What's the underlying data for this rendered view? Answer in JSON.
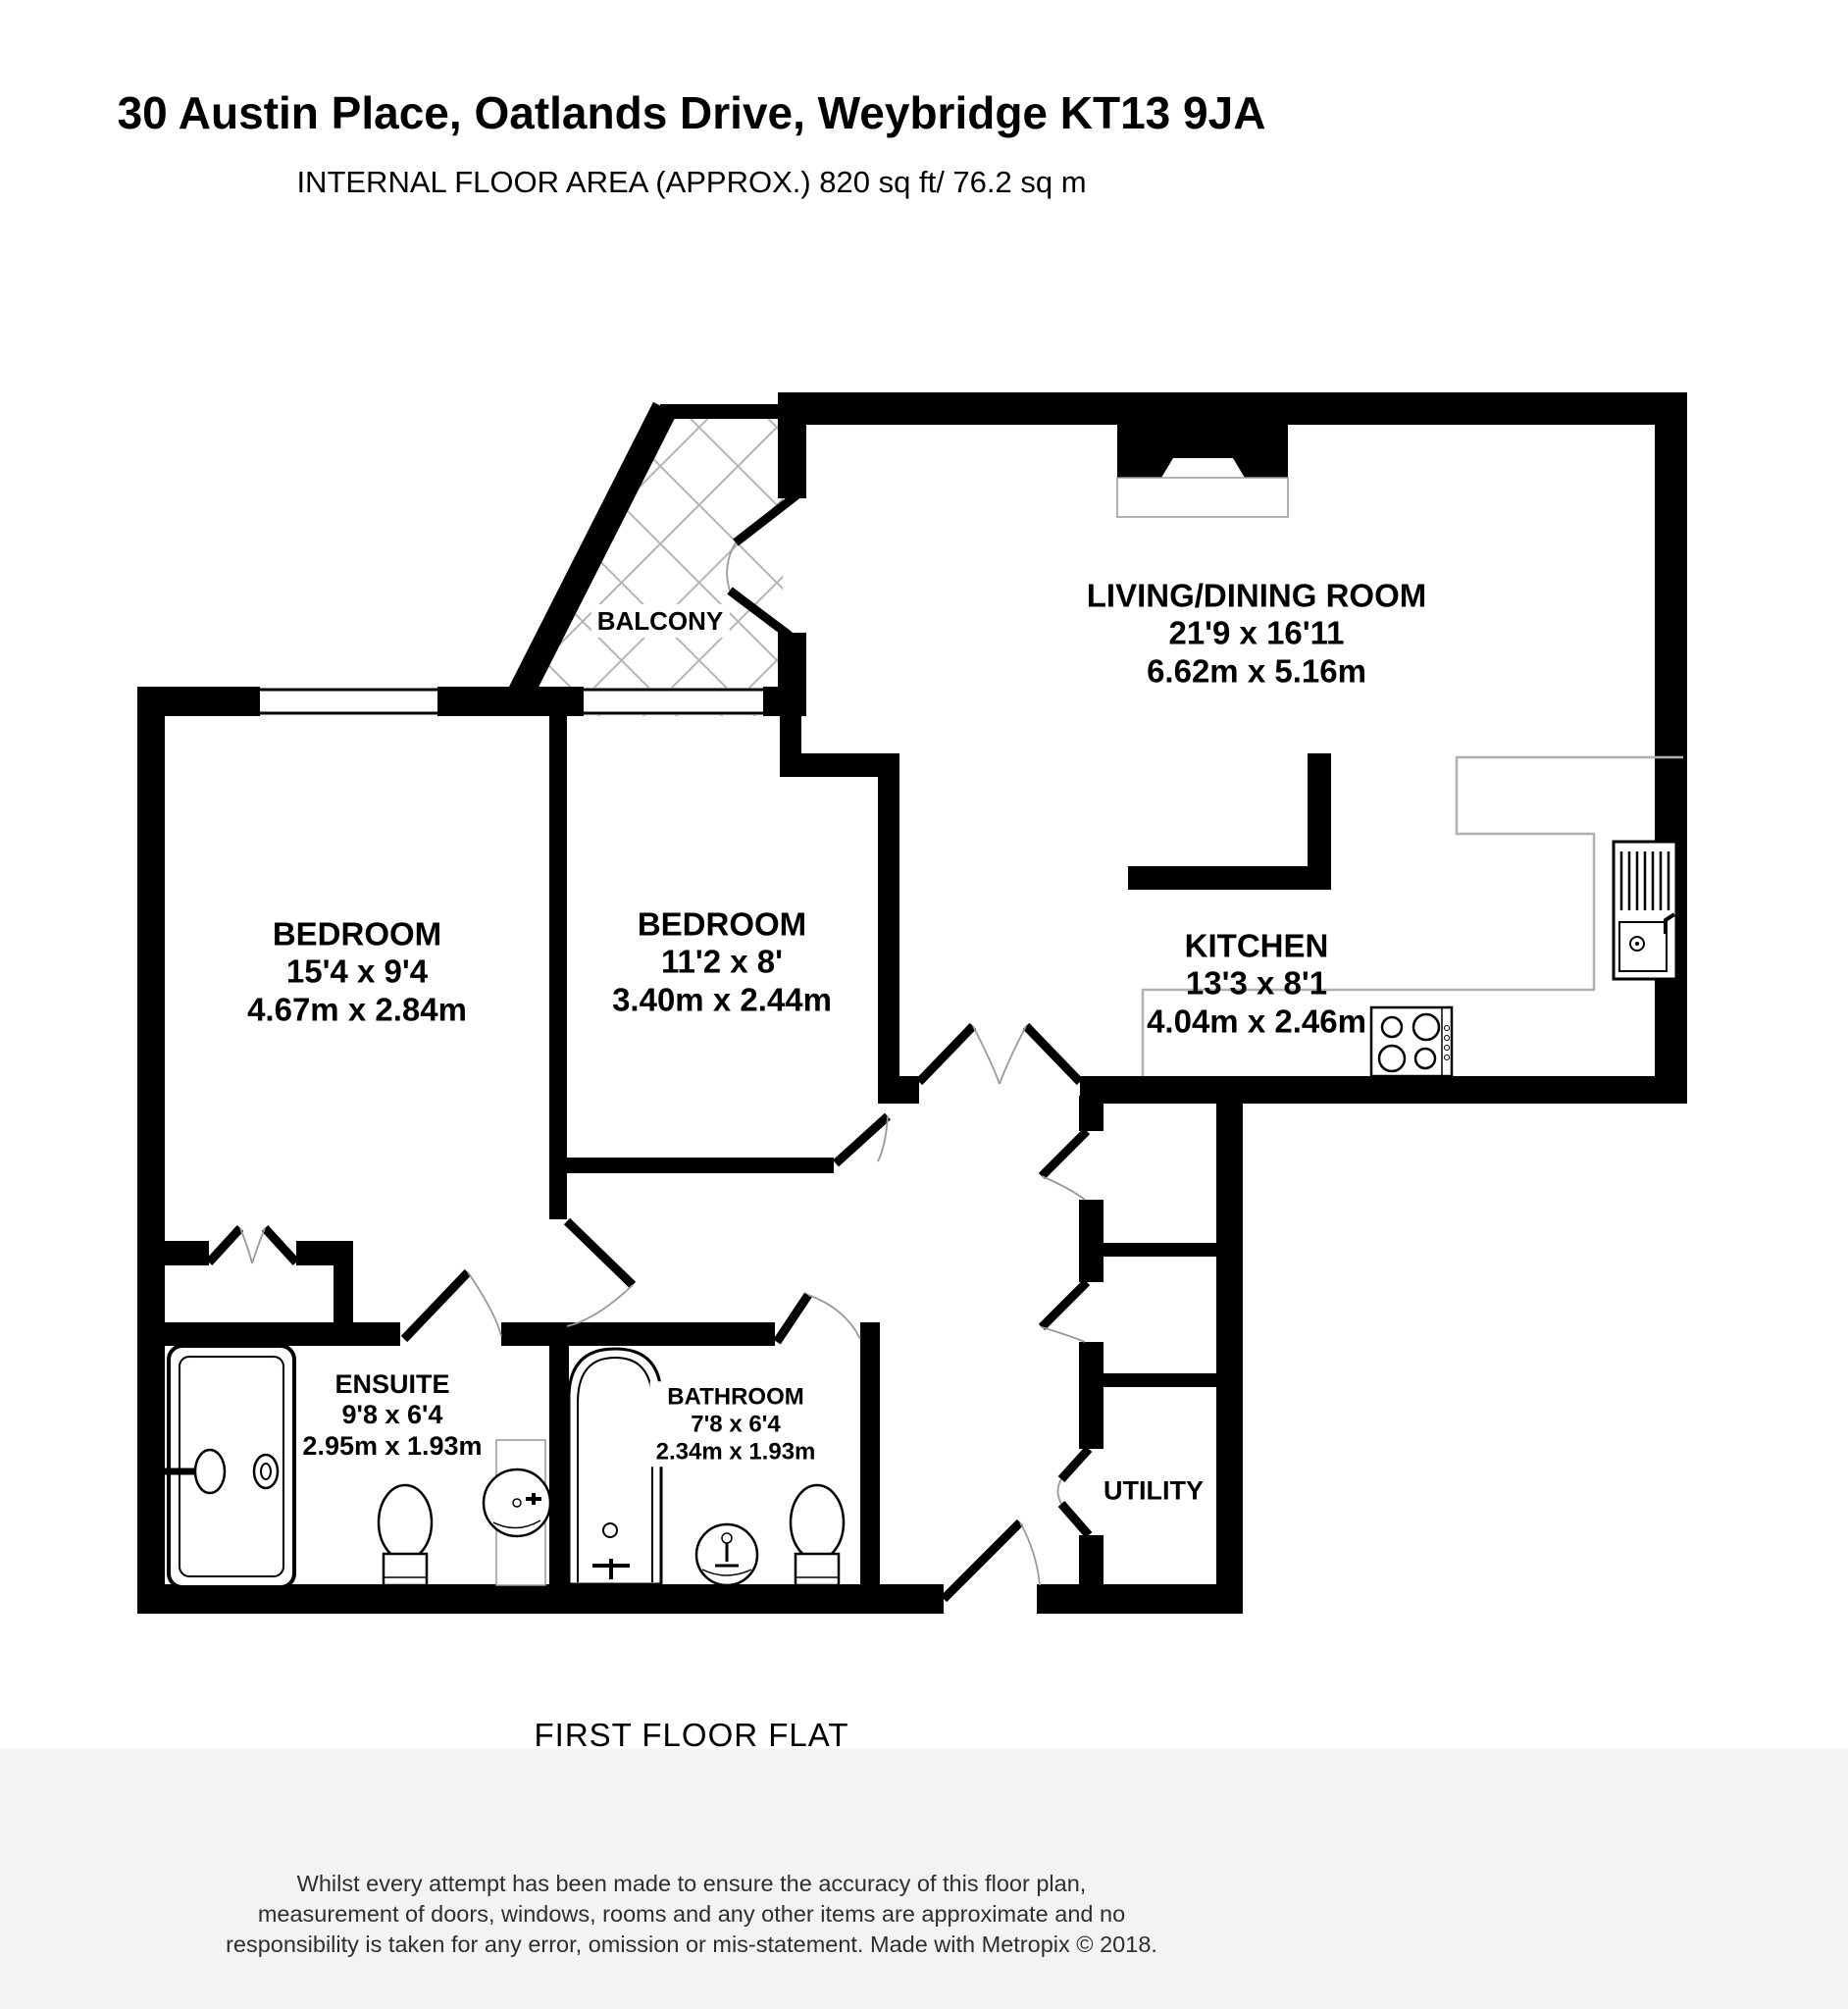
{
  "header": {
    "title": "30 Austin Place, Oatlands Drive, Weybridge KT13 9JA",
    "subtitle": "INTERNAL FLOOR AREA (APPROX.) 820 sq ft/ 76.2 sq m"
  },
  "rooms": {
    "living": {
      "name": "LIVING/DINING ROOM",
      "imperial": "21'9 x 16'11",
      "metric": "6.62m x 5.16m"
    },
    "bedroom1": {
      "name": "BEDROOM",
      "imperial": "15'4 x 9'4",
      "metric": "4.67m x 2.84m"
    },
    "bedroom2": {
      "name": "BEDROOM",
      "imperial": "11'2 x 8'",
      "metric": "3.40m x 2.44m"
    },
    "kitchen": {
      "name": "KITCHEN",
      "imperial": "13'3 x 8'1",
      "metric": "4.04m x 2.46m"
    },
    "ensuite": {
      "name": "ENSUITE",
      "imperial": "9'8 x 6'4",
      "metric": "2.95m x 1.93m"
    },
    "bathroom": {
      "name": "BATHROOM",
      "imperial": "7'8 x 6'4",
      "metric": "2.34m x 1.93m"
    },
    "utility": {
      "name": "UTILITY"
    },
    "balcony": {
      "name": "BALCONY"
    }
  },
  "footer": {
    "floor_label": "FIRST FLOOR FLAT",
    "disclaimer_line1": "Whilst every attempt has been made to ensure the accuracy of this floor plan,",
    "disclaimer_line2": "measurement of doors, windows, rooms and any other items are approximate and no",
    "disclaimer_line3": "responsibility is taken for any error, omission or mis-statement. Made with Metropix © 2018."
  },
  "colors": {
    "wall": "#000000",
    "counter": "#b0b0b0",
    "hatch": "#b5b5b5",
    "door_arc": "#999999",
    "footer_band": "#f3f3f3"
  }
}
